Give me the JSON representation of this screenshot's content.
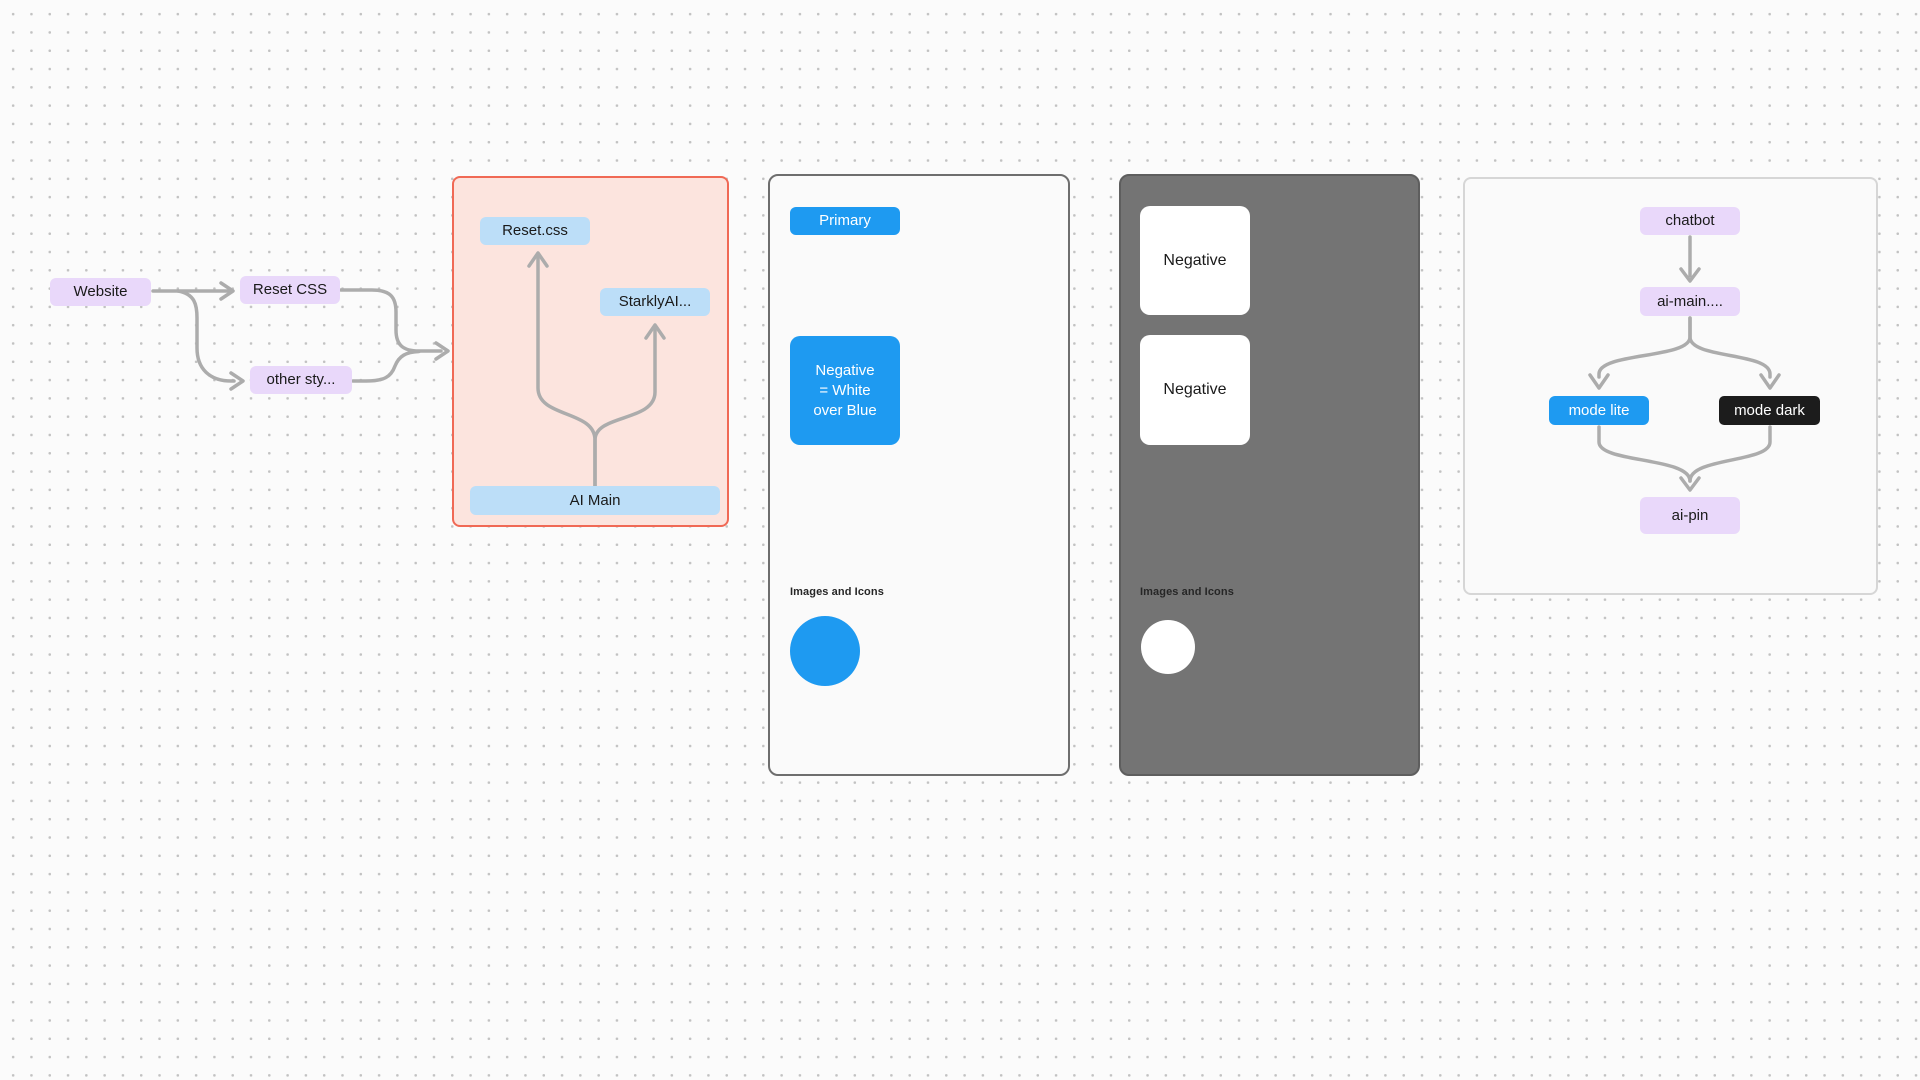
{
  "theme": {
    "canvas-bg": "#FBFBFB",
    "dot-color": "#C2C2C2",
    "connector": "#ACACAC",
    "lavender": "#E9D8FA",
    "lightblue": "#BCDEF8",
    "blue": "#1E9AF1",
    "black-node": "#1C1C1C",
    "pink-fill": "#FCE4DE",
    "pink-border": "#F06955",
    "panel-light": "#FAFAFA",
    "panel-light-border": "#6E6E6E",
    "panel-dark": "#747474",
    "panel-dark-border": "#5E5E5E",
    "panel-right-border": "#D6D6D6",
    "text-dark": "#1A1A1A"
  },
  "website_flow": {
    "website": "Website",
    "reset_css": "Reset CSS",
    "other_styles": "other sty..."
  },
  "css_frame": {
    "reset_css_file": "Reset.css",
    "starkly_ai": "StarklyAI...",
    "ai_main": "AI Main"
  },
  "light_frame": {
    "primary": "Primary",
    "negative_block": "Negative\n= White\nover Blue",
    "images_label": "Images and Icons"
  },
  "dark_frame": {
    "negative_top": "Negative",
    "negative_bottom": "Negative",
    "images_label": "Images and Icons"
  },
  "chatbot_frame": {
    "chatbot": "chatbot",
    "ai_main": "ai-main....",
    "mode_lite": "mode lite",
    "mode_dark": "mode dark",
    "ai_pin": "ai-pin"
  }
}
